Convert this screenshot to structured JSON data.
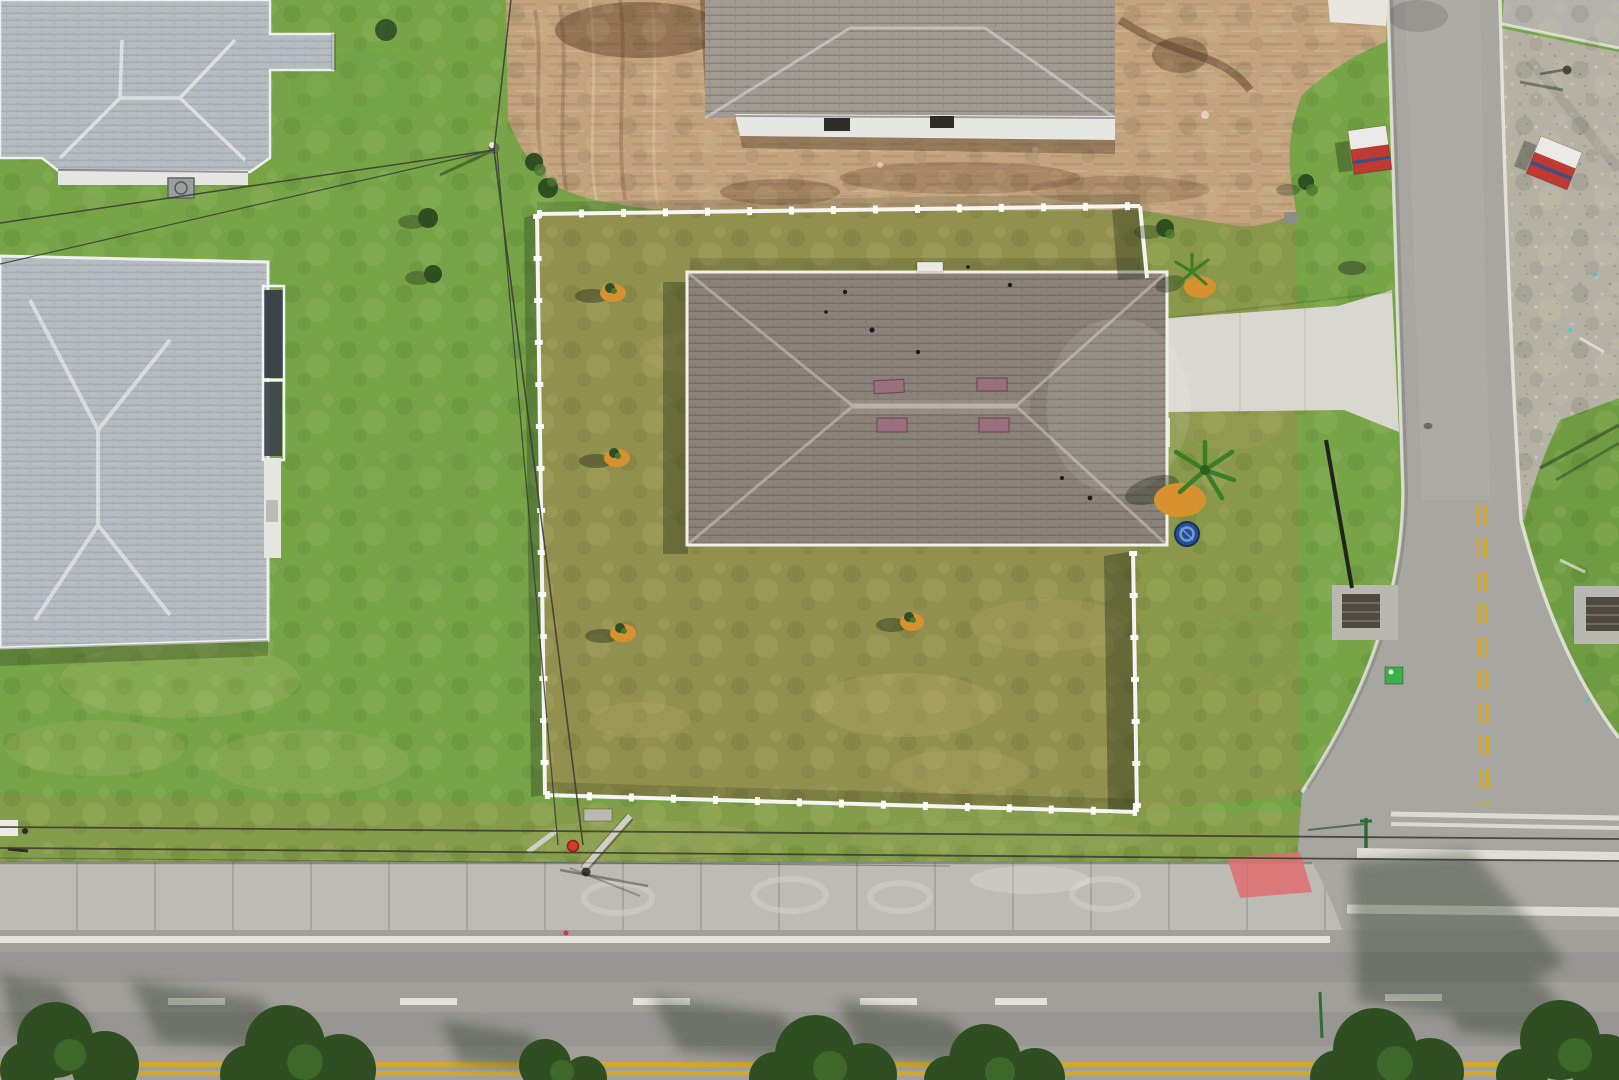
{
  "meta": {
    "kind": "aerial-drone-photo",
    "width_px": 1619,
    "height_px": 1080
  },
  "scene": {
    "objects": [
      "fenced-vacant-lot-with-new-home",
      "hip-roof-house",
      "white-vinyl-perimeter-fence",
      "concrete-driveway",
      "neighbor-house-top-left",
      "neighbor-house-left",
      "house-under-construction",
      "graded-dirt-lot",
      "gravel-lot",
      "side-street-with-yellow-centerline",
      "main-road-with-sidewalk",
      "storm-drains",
      "porta-potties",
      "utility-poles",
      "power-lines",
      "palm-trees-with-orange-mulch",
      "saplings-with-orange-mulch",
      "blue-kiddie-pool",
      "street-trees-with-shadows",
      "pink-curb-ramp-paint",
      "fire-hydrant",
      "green-utility-box"
    ]
  },
  "colors": {
    "grass-outer": "#76a447",
    "grass-lot": "#92904e",
    "grass-strip": "#89984a",
    "grass-right": "#6f9c42",
    "grass-park": "#8a9a4d",
    "dirt": "#c2a37e",
    "dirt-dark": "#8a6342",
    "dirt-light": "#e0caa6",
    "gravel": "#b6b1a5",
    "roof-main": "#8b8379",
    "roof-light": "#b7bcc1",
    "roof-construction": "#a19b93",
    "ridge-light": "#e7eaea",
    "fence": "#f4f4f0",
    "road": "#a7a6a1",
    "road-h": "#a09f9a",
    "sidewalk": "#bdbcb4",
    "driveway": "#d9d8d0",
    "concrete-pad": "#b9b8b0",
    "line-white": "#eae9e1",
    "line-yellow": "#d2a82b",
    "ramp-pink": "#dd6f72",
    "potty-red": "#bf3a31",
    "potty-white": "#eceae6",
    "potty-blue": "#3d4f8c",
    "pool-blue": "#2a4f8e",
    "pool-light": "#6e9bd8",
    "palm": "#3c7d28",
    "mulch": "#d8912f",
    "tree": "#2f4f23",
    "tree-light": "#4a7a2f",
    "shadow": "#1c2913",
    "utility-green": "#3cb04a",
    "hydrant": "#d23b2f",
    "wire": "#3a3a33",
    "pipe": "#23231e",
    "screen-dark": "#3c444a",
    "wall-white": "#e6e7e3",
    "ac-gray": "#9aa0a2",
    "grate-dark": "#4e4a40"
  }
}
